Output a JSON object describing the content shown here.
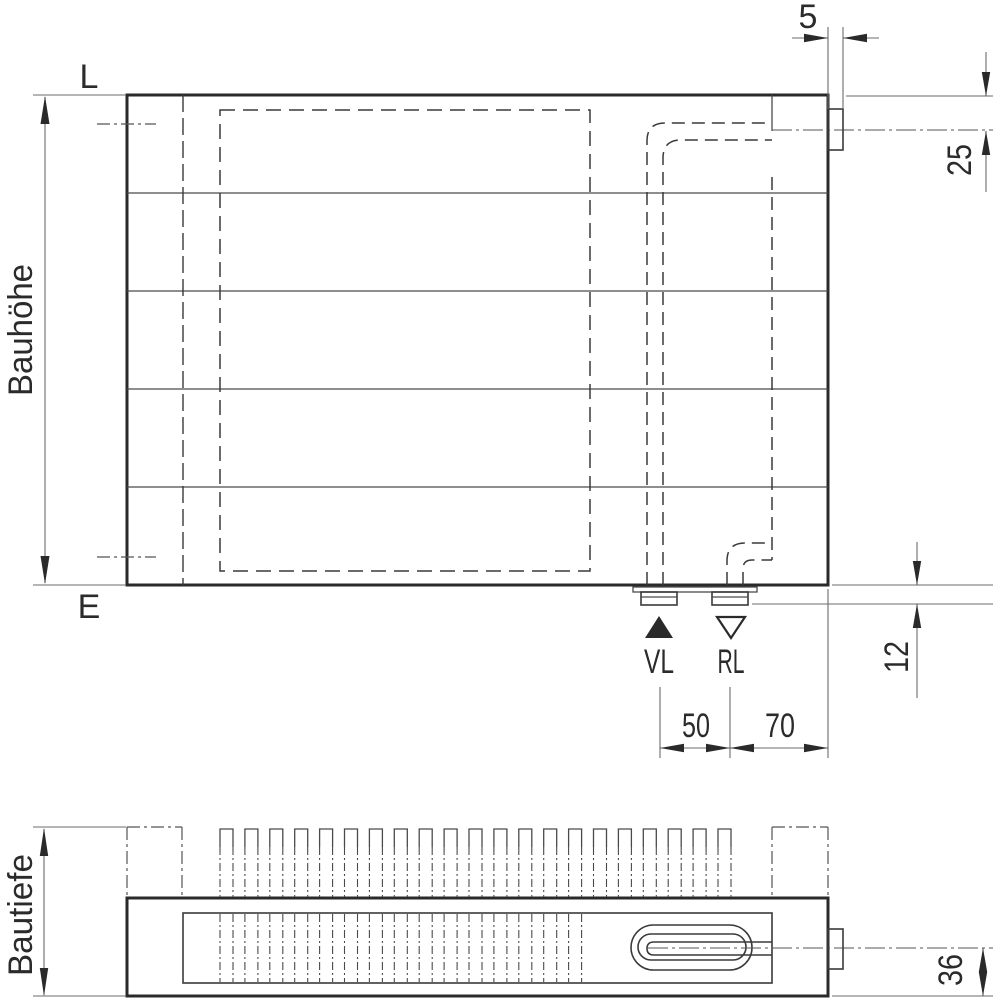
{
  "colors": {
    "background": "#ffffff",
    "body_line": "#2a2a2a",
    "dimension_line": "#6b6b6b",
    "text": "#2b2b2b"
  },
  "icons": {
    "supply_marker": "filled-triangle-up-icon",
    "return_marker": "outline-triangle-down-icon"
  },
  "front_view": {
    "label_vent": "L",
    "label_drain": "E",
    "dim_height": "Bauhöhe",
    "dim_tab_width": "5",
    "dim_top_tapping_offset": "25",
    "dim_connection_protrusion": "12",
    "label_supply": "VL",
    "label_return": "RL",
    "dim_supply_return_spacing": "50",
    "dim_return_edge_spacing": "70"
  },
  "top_view": {
    "dim_depth": "Bautiefe",
    "dim_pipe_center_offset": "36"
  }
}
